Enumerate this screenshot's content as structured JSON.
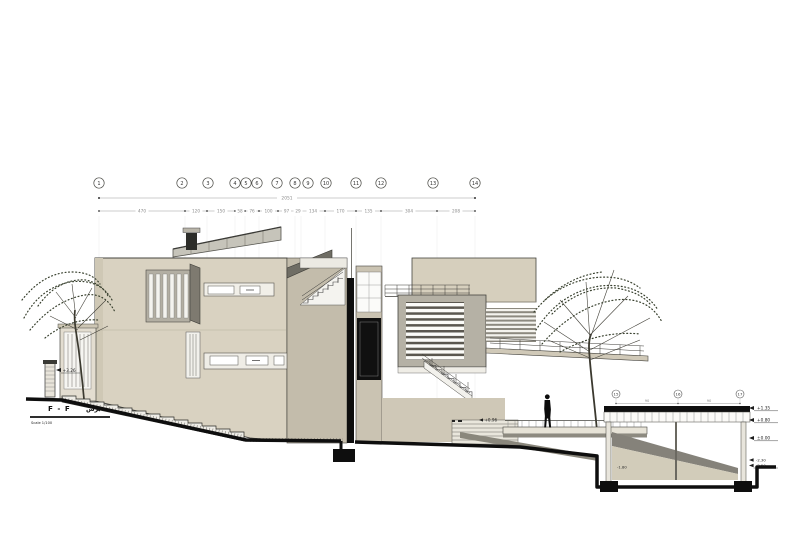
{
  "drawing": {
    "section_title": "F - F",
    "section_title_ar": "برش",
    "scale_label": "Scale 1/100"
  },
  "grid": {
    "labels": [
      "1",
      "2",
      "3",
      "4",
      "5",
      "6",
      "7",
      "8",
      "9",
      "10",
      "11",
      "12",
      "13",
      "14"
    ]
  },
  "dimensions": {
    "total": "2051",
    "segments": [
      "470",
      "120",
      "150",
      "58",
      "76",
      "100",
      "97",
      "29",
      "134",
      "170",
      "135",
      "304",
      "208"
    ]
  },
  "sub_grid": {
    "labels": [
      "15",
      "16",
      "17"
    ],
    "segments": [
      "90",
      "90"
    ]
  },
  "levels": {
    "left_terrace": "+3.26",
    "mid_landing": "+0.96",
    "roof_deck": "+1.35",
    "deck_soffit": "+0.80",
    "ground": "±0.00",
    "footing_top": "-2.30",
    "footing_bottom": "-2.50",
    "basement_floor": "-1.80"
  },
  "colors": {
    "facade": "#d9d2c1",
    "facade_shade": "#c3bcab",
    "glazing": "#c6c4ba",
    "section_cut": "#0e0e0e",
    "foliage": "#39412f",
    "dim_text": "#8b8b8b"
  }
}
